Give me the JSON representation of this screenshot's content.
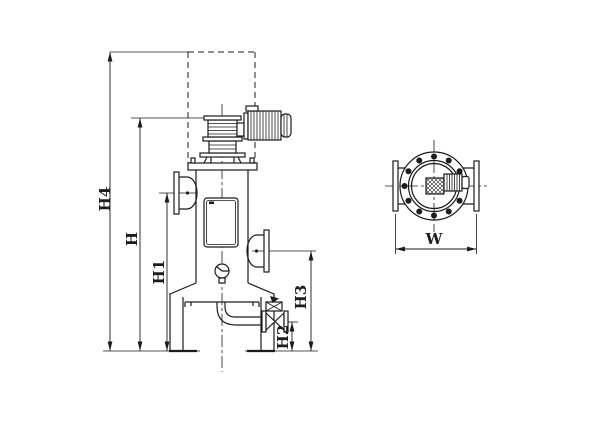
{
  "colors": {
    "background": "#ffffff",
    "line": "#1c1c1c"
  },
  "front_view": {
    "dims": {
      "h4": "H4",
      "h": "H",
      "h1": "H1",
      "h2": "H2",
      "h3": "H3"
    }
  },
  "top_view": {
    "dims": {
      "w": "W"
    }
  }
}
